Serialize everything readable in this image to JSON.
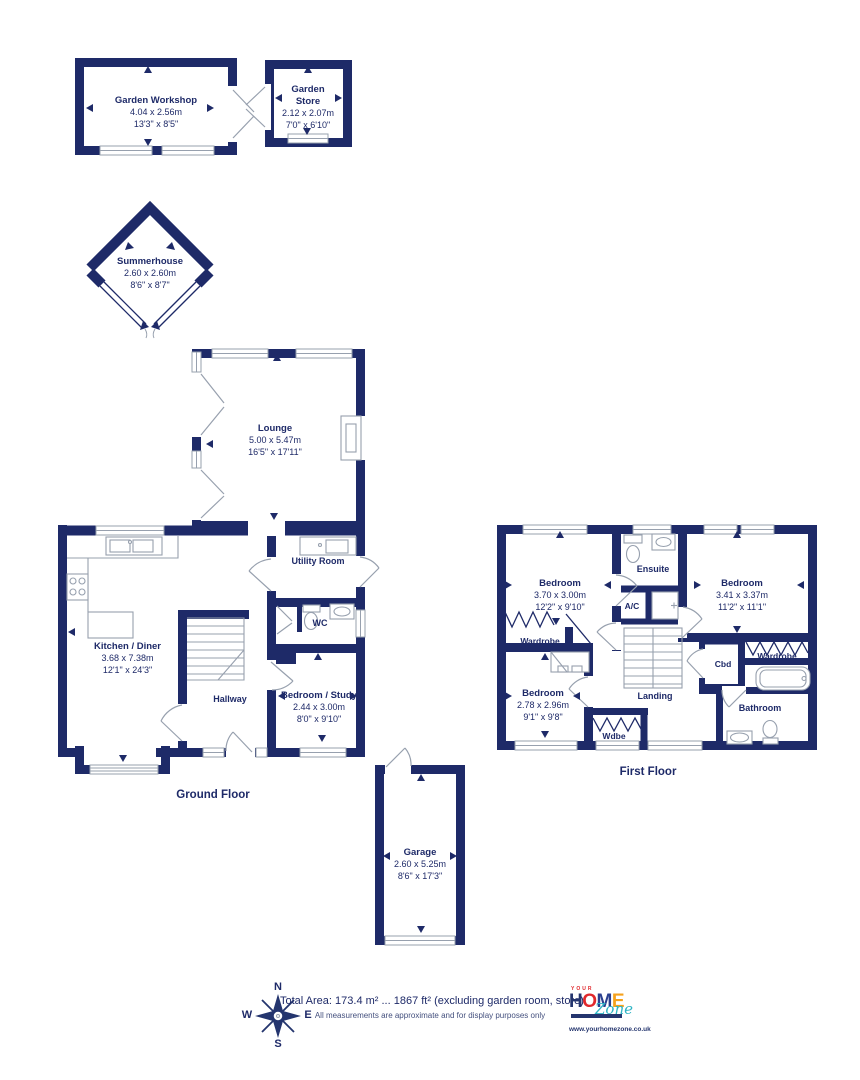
{
  "colors": {
    "wall": "#1e2a68",
    "detail_line": "#97a0ae",
    "text": "#1e2a68",
    "logo_red": "#e0282c",
    "logo_navy": "#24356e",
    "logo_yellow": "#f6a21c",
    "logo_teal": "#2fb4c4"
  },
  "outbuildings": {
    "workshop": {
      "name": "Garden Workshop",
      "metric": "4.04 x 2.56m",
      "imperial": "13'3\" x 8'5\""
    },
    "store": {
      "line1": "Garden",
      "line2": "Store",
      "metric": "2.12 x 2.07m",
      "imperial": "7'0\" x 6'10\""
    },
    "summerhouse": {
      "name": "Summerhouse",
      "metric": "2.60 x 2.60m",
      "imperial": "8'6\" x 8'7\""
    }
  },
  "ground_floor": {
    "title": "Ground Floor",
    "lounge": {
      "name": "Lounge",
      "metric": "5.00 x 5.47m",
      "imperial": "16'5\" x 17'11\""
    },
    "kitchen": {
      "name": "Kitchen / Diner",
      "metric": "3.68 x 7.38m",
      "imperial": "12'1\" x 24'3\""
    },
    "utility": {
      "name": "Utility Room"
    },
    "wc": {
      "name": "WC"
    },
    "hallway": {
      "name": "Hallway"
    },
    "study": {
      "name": "Bedroom / Study",
      "metric": "2.44 x 3.00m",
      "imperial": "8'0\" x 9'10\""
    }
  },
  "first_floor": {
    "title": "First Floor",
    "bedroom1": {
      "name": "Bedroom",
      "metric": "3.70 x 3.00m",
      "imperial": "12'2\" x 9'10\""
    },
    "bedroom2": {
      "name": "Bedroom",
      "metric": "3.41 x 3.37m",
      "imperial": "11'2\" x 11'1\""
    },
    "bedroom3": {
      "name": "Bedroom",
      "metric": "2.78 x 2.96m",
      "imperial": "9'1\" x 9'8\""
    },
    "ensuite": {
      "name": "Ensuite"
    },
    "ac": {
      "name": "A/C"
    },
    "wardrobe1": {
      "name": "Wardrobe"
    },
    "wardrobe2": {
      "name": "Wardrobe"
    },
    "wdbe": {
      "name": "Wdbe"
    },
    "cbd": {
      "name": "Cbd"
    },
    "landing": {
      "name": "Landing"
    },
    "bathroom": {
      "name": "Bathroom"
    }
  },
  "garage": {
    "name": "Garage",
    "metric": "2.60 x 5.25m",
    "imperial": "8'6\" x 17'3\""
  },
  "footer": {
    "total_area": "Total Area: 173.4 m² ... 1867 ft² (excluding garden room, store)",
    "disclaimer": "All measurements are approximate and for display purposes only",
    "compass": {
      "n": "N",
      "e": "E",
      "s": "S",
      "w": "W"
    },
    "logo": {
      "your": "YOUR",
      "h": "H",
      "o": "O",
      "m": "M",
      "e": "E",
      "zone": "Zone",
      "url": "www.yourhomezone.co.uk"
    }
  }
}
